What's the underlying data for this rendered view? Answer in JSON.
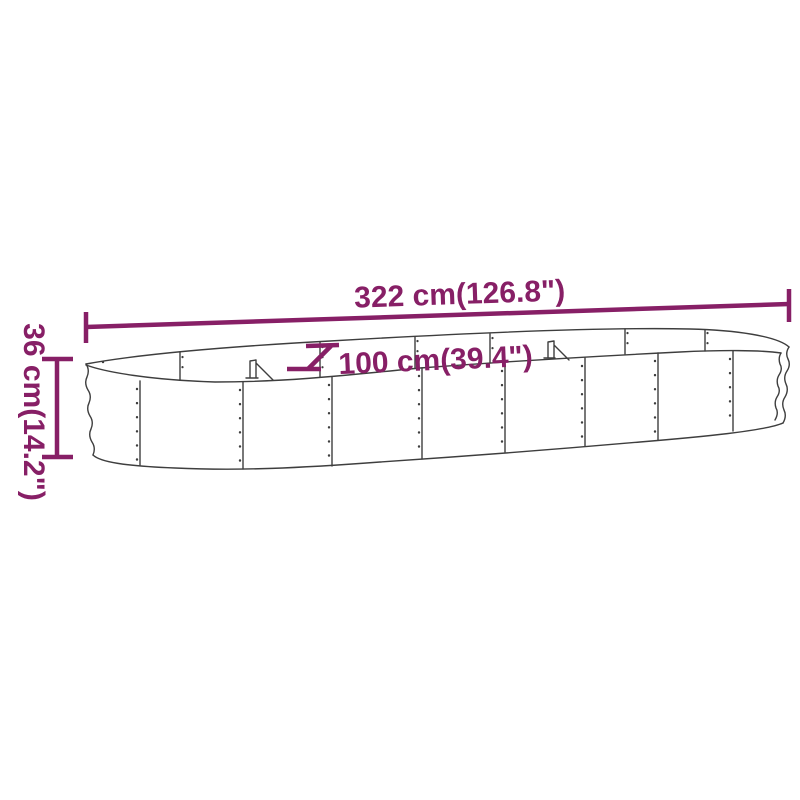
{
  "diagram": {
    "depicts": "oval-raised-garden-bed-dimension-diagram",
    "labels": {
      "length": "322 cm(126.8\")",
      "width": "100 cm(39.4\")",
      "height": "36 cm(14.2\")"
    },
    "colors": {
      "dimension": "#871F66",
      "outline": "#3E3E3E",
      "background": "#FFFFFF"
    }
  }
}
